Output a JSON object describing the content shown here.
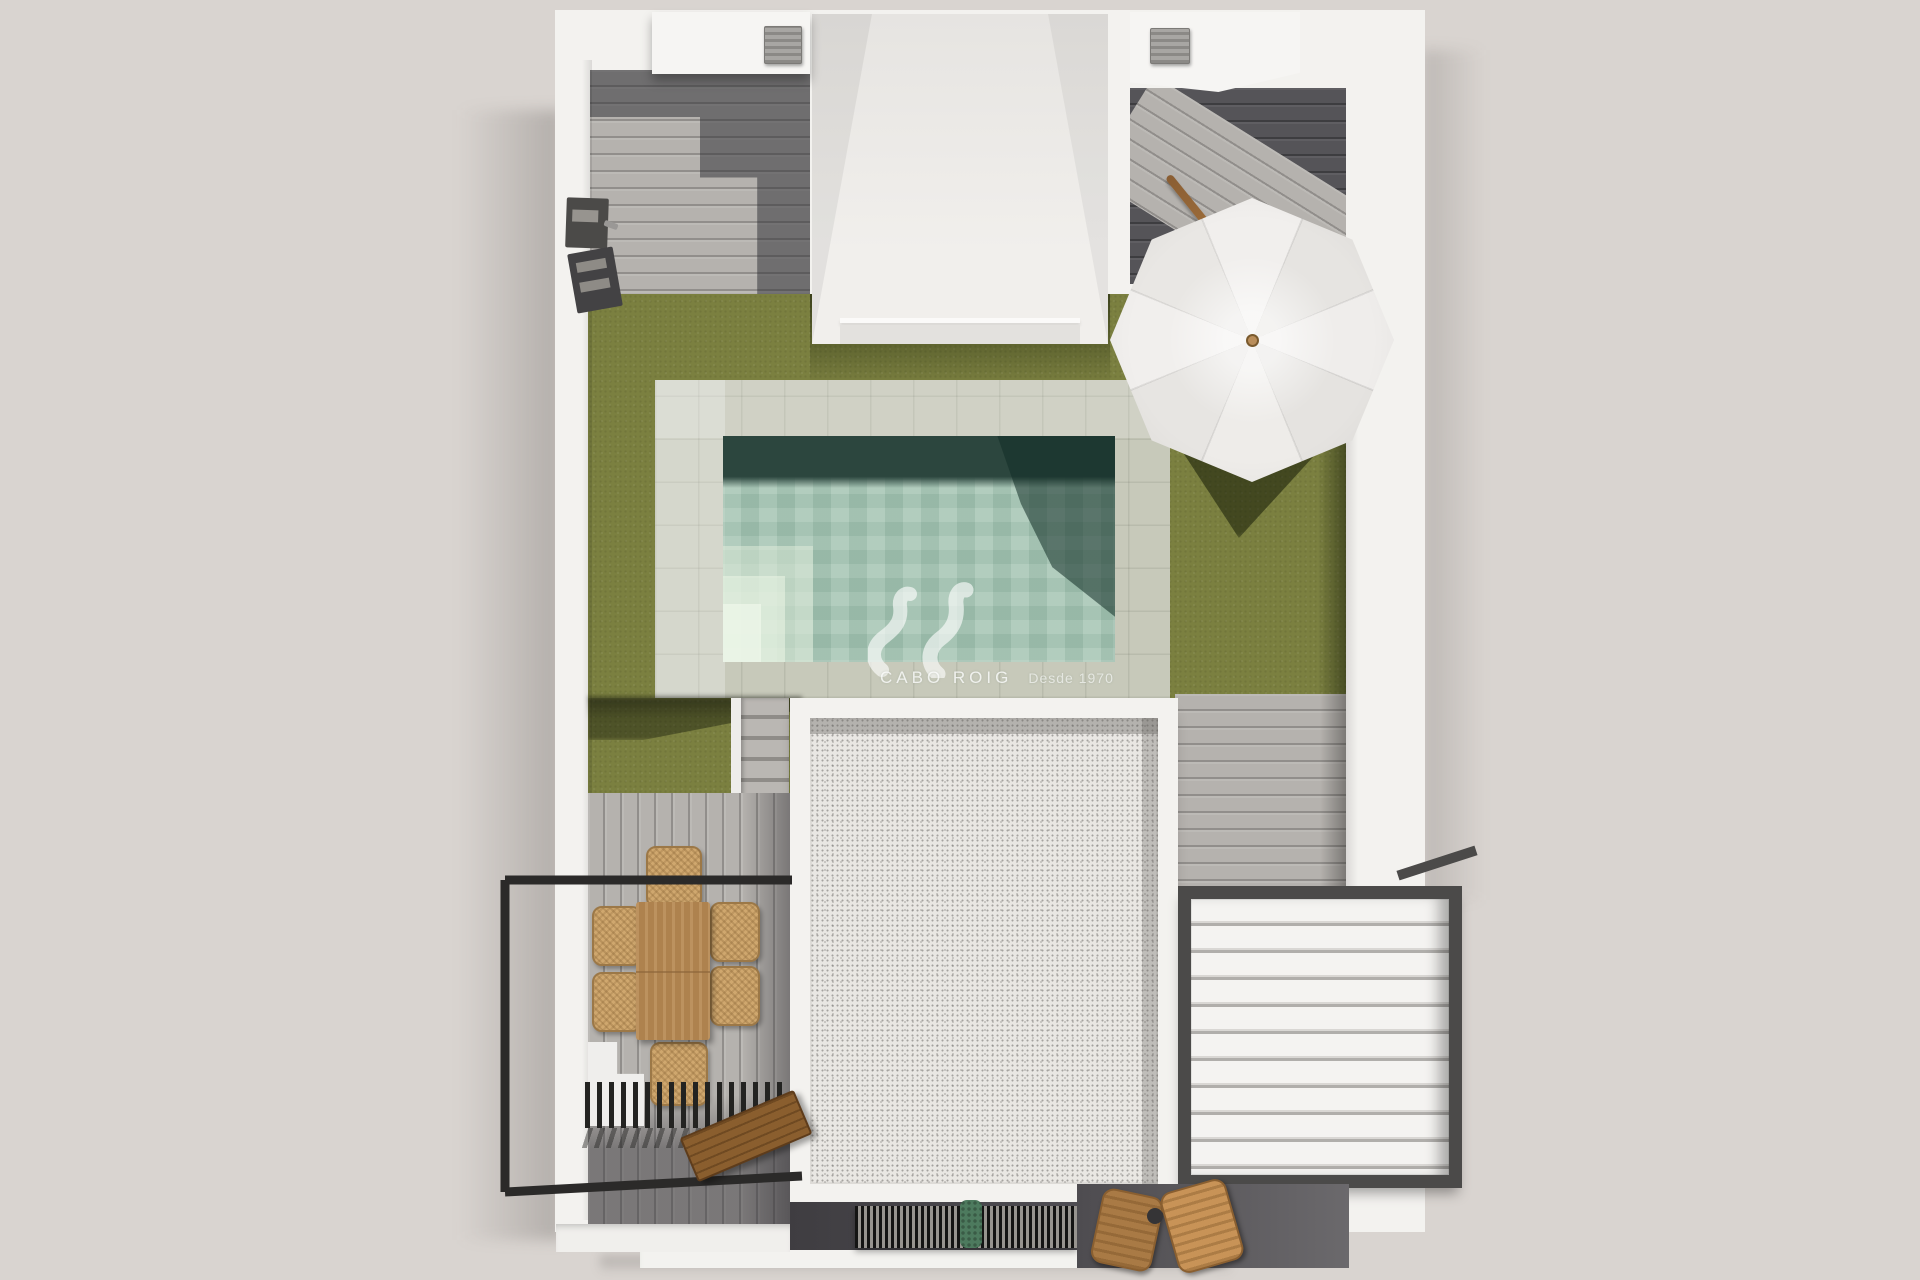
{
  "watermark": {
    "brand": "CABO ROIG",
    "tagline": "Desde 1970"
  },
  "palette": {
    "bg": "#d9d4d0",
    "white": "#f3f2ef",
    "whiteShade": "#e4e2df",
    "deckLight": "#b5b2ae",
    "deckDark": "#555458",
    "grass": "#7b8040",
    "grassShadow": "#39441a",
    "stone": "#c7c9ba",
    "water": "#a7c6b5",
    "waterDeep": "#2c463e",
    "waterStep": "#dce7d3",
    "gravel": "#e9e7e3",
    "gravelBand": "#a19f9c",
    "wood": "#b88b55",
    "wicker": "#cfa76e",
    "bench": "#8a5e2e",
    "metal": "#2b2a29",
    "frame": "#4b4a49",
    "louverGap": "#b0aeab",
    "umbrella": "#f1efed",
    "umbrellaShade": "#e6e4e1",
    "knob": "#b98d5a",
    "plant": "#4d7a5e",
    "floorDark": "#56545a"
  },
  "scene": {
    "type": "top-down 3D architectural render of a villa plot",
    "elements": [
      "perimeter-white-walls",
      "rooftop-box-left",
      "rooftop-box-right",
      "ac-unit-left",
      "ac-unit-right",
      "courtyard-lightwell",
      "wood-deck-top-left",
      "wood-deck-top-right",
      "lawn",
      "swimming-pool",
      "pool-sun-shelf-steps",
      "pool-stone-surround",
      "parasol",
      "parasol-pole",
      "garden-stairs",
      "gravel-flat-roof",
      "dining-table",
      "dining-chairs",
      "terrace-railing",
      "slatted-pergola",
      "wooden-bench",
      "louvered-pergola-roof",
      "privacy-slats",
      "potted-plant",
      "lounge-chairs",
      "side-table",
      "barbecue-unit"
    ],
    "dining_chair_count": 6,
    "louver_count": 10
  }
}
